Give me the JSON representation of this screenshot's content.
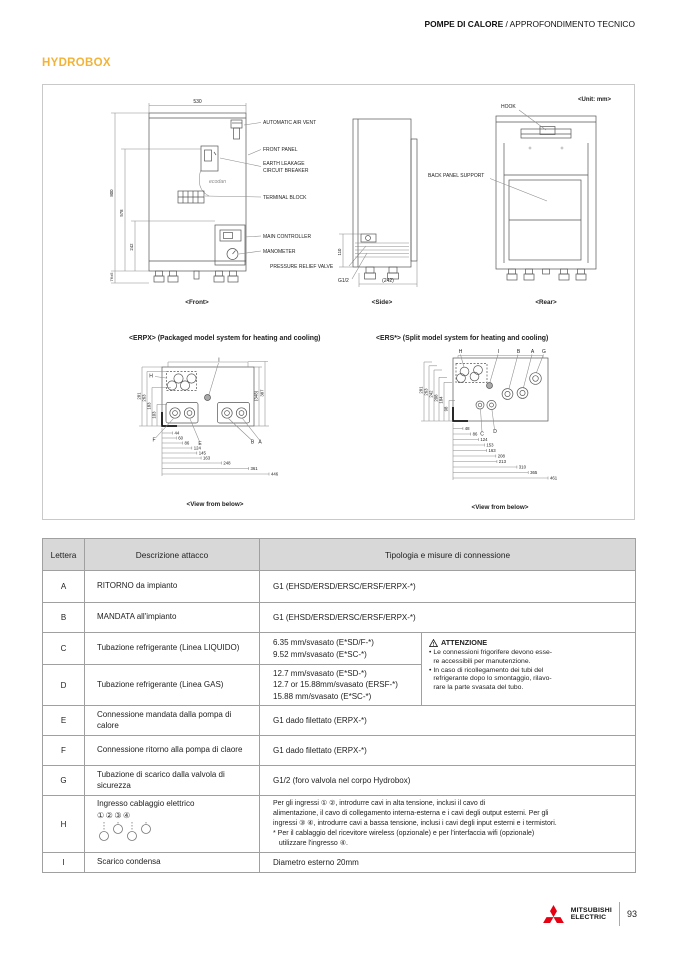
{
  "header": {
    "breadcrumb_bold": "POMPE DI CALORE",
    "breadcrumb_rest": " / APPROFONDIMENTO TECNICO",
    "title": "HYDROBOX"
  },
  "diagram": {
    "unit_note": "<Unit: mm>",
    "front": {
      "caption": "<Front>",
      "dim_width": "530",
      "dim_800": "800",
      "dim_578": "578",
      "dim_242": "242",
      "dim_76": "76±5",
      "label_air_vent": "AUTOMATIC AIR VENT",
      "label_front_panel": "FRONT PANEL",
      "label_earth_1": "EARTH LEAKAGE",
      "label_earth_2": "CIRCUIT BREAKER",
      "label_terminal": "TERMINAL BLOCK",
      "label_controller": "MAIN CONTROLLER",
      "label_manometer": "MANOMETER",
      "label_valve": "PRESSURE RELIEF VALVE",
      "ecodan": "ecodan"
    },
    "side": {
      "caption": "<Side>",
      "dim_110": "110",
      "dim_242": "(242)",
      "label_g12": "G1/2"
    },
    "rear": {
      "caption": "<Rear>",
      "label_hook": "HOOK",
      "label_support": "BACK PANEL SUPPORT"
    },
    "erpx": {
      "title": "<ERPX> (Packaged model system for heating and cooling)",
      "caption": "<View from below>",
      "left_dims": [
        "281",
        "263",
        "183",
        "103"
      ],
      "right_dims": [
        "(348)",
        "387"
      ],
      "bottom_dims": [
        "44",
        "60",
        "86",
        "124",
        "145",
        "163",
        "248",
        "361",
        "446"
      ],
      "labels": {
        "h": "H",
        "i": "I",
        "f": "F",
        "e": "E",
        "b": "B",
        "a": "A"
      }
    },
    "ers": {
      "title": "<ERS*> (Split model system for heating and cooling)",
      "caption": "<View from below>",
      "left_dims": [
        "281",
        "263",
        "242",
        "208",
        "184",
        "98"
      ],
      "bottom_dims": [
        "48",
        "86",
        "124",
        "153",
        "163",
        "208",
        "213",
        "310",
        "365",
        "461"
      ],
      "labels": {
        "h": "H",
        "i": "I",
        "b": "B",
        "a": "A",
        "g": "G",
        "c": "C",
        "d": "D"
      }
    }
  },
  "table": {
    "col_lettera": "Lettera",
    "col_descrizione": "Descrizione attacco",
    "col_tipologia": "Tipologia e misure di connessione",
    "rows": [
      {
        "letter": "A",
        "desc": "RITORNO da impianto",
        "conn": "G1 (EHSD/ERSD/ERSC/ERSF/ERPX-*)"
      },
      {
        "letter": "B",
        "desc": "MANDATA all'impianto",
        "conn": "G1 (EHSD/ERSD/ERSC/ERSF/ERPX-*)"
      },
      {
        "letter": "C",
        "desc": "Tubazione refrigerante (Linea LIQUIDO)",
        "conn": "6.35 mm/svasato (E*SD/F-*)\n9.52 mm/svasato (E*SC-*)"
      },
      {
        "letter": "D",
        "desc": "Tubazione refrigerante (Linea GAS)",
        "conn": "12.7 mm/svasato (E*SD-*)\n12.7 or 15.88mm/svasato (ERSF-*)\n15.88 mm/svasato (E*SC-*)"
      },
      {
        "letter": "E",
        "desc": "Connessione mandata dalla pompa di calore",
        "conn": "G1 dado filettato (ERPX-*)"
      },
      {
        "letter": "F",
        "desc": "Connessione ritorno alla pompa di claore",
        "conn": "G1 dado filettato (ERPX-*)"
      },
      {
        "letter": "G",
        "desc": "Tubazione di scarico dalla valvola di sicurezza",
        "conn": "G1/2 (foro valvola nel corpo Hydrobox)"
      },
      {
        "letter": "H",
        "desc": "Ingresso cablaggio elettrico",
        "desc_numbers": "①②③④",
        "conn": "Per gli ingressi ① ②, introdurre cavi in alta tensione, inclusi il cavo di\nalimentazione, il cavo di collegamento interna-esterna e i cavi degli output esterni. Per gli\ningressi ③ ④, introdurre cavi a bassa tensione, inclusi i cavi degli input esterni e i termistori.\n* Per il cablaggio del ricevitore wireless (opzionale) e per l'interfaccia wifi (opzionale)\n   utilizzare l'ingresso ④."
      },
      {
        "letter": "I",
        "desc": "Scarico condensa",
        "conn": "Diametro esterno 20mm"
      }
    ],
    "attention": {
      "title": "ATTENZIONE",
      "bullet1": "Le connessioni frigorifere devono esse-\nre accessibili per manutenzione.",
      "bullet2": "In caso di ricollegamento dei tubi del\nrefrigerante dopo lo smontaggio, rilavo-\nrare la parte svasata del tubo."
    }
  },
  "footer": {
    "brand_line1": "MITSUBISHI",
    "brand_line2": "ELECTRIC",
    "page_number": "93"
  },
  "colors": {
    "accent": "#F2B338",
    "brand_red": "#E60012",
    "table_header_bg": "#D8D8D8"
  }
}
